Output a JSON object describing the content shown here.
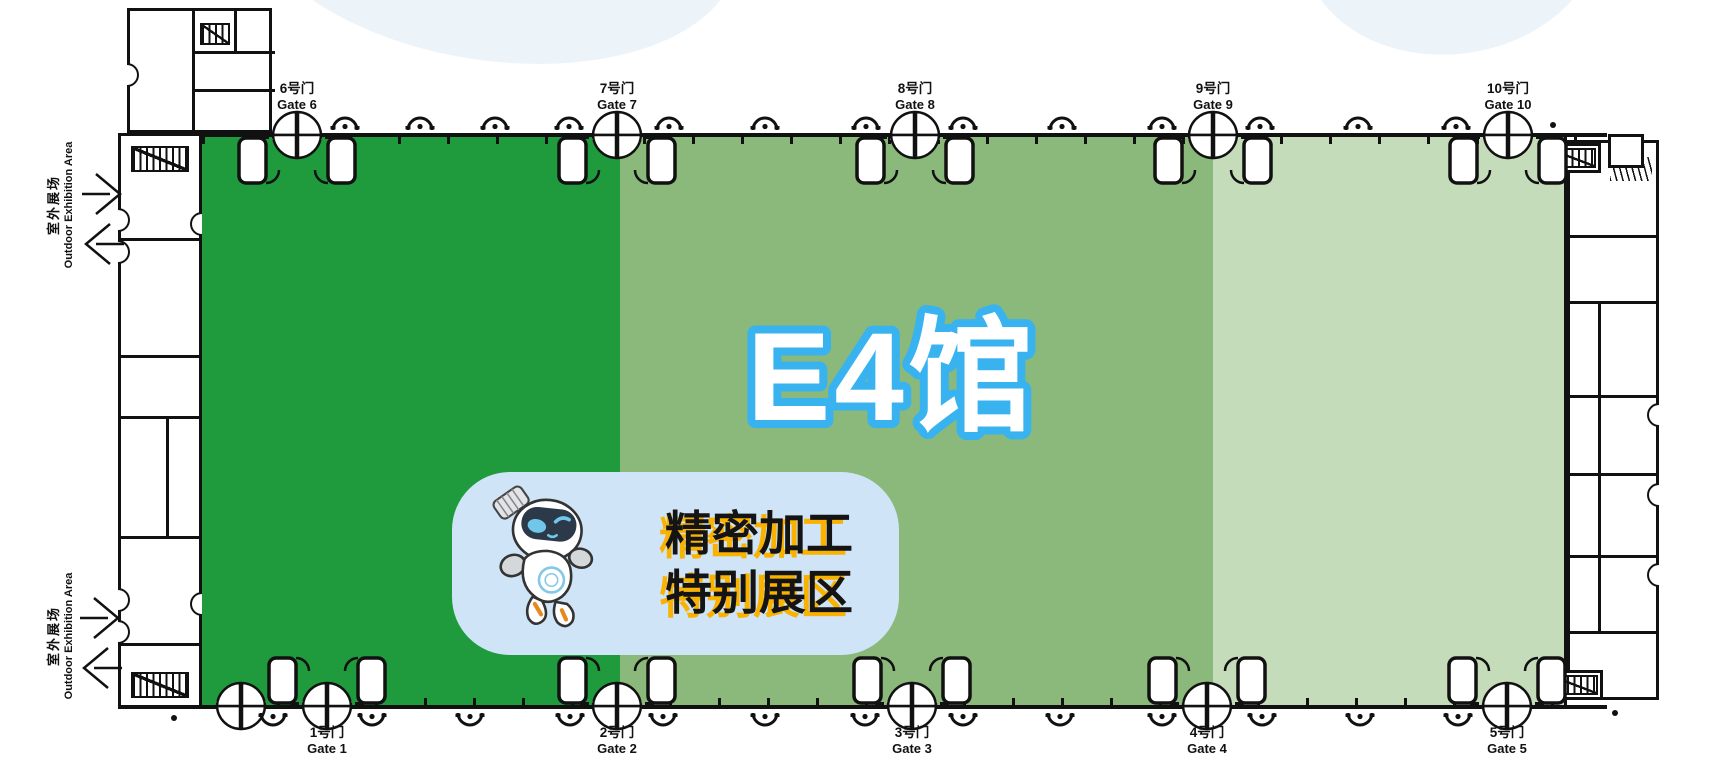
{
  "page": {
    "width": 1709,
    "height": 783,
    "background": "#ffffff"
  },
  "hall": {
    "title": "E4馆",
    "title_fill": "#ffffff",
    "title_stroke": "#38b3ef",
    "zones": [
      {
        "name": "zone-dark-green",
        "color": "#1f9b3d",
        "x": 200,
        "w": 420
      },
      {
        "name": "zone-mid-green",
        "color": "#8ab97b",
        "x": 620,
        "w": 593
      },
      {
        "name": "zone-light-green",
        "color": "#c5dcba",
        "x": 1213,
        "w": 351
      }
    ]
  },
  "gates": {
    "top": [
      {
        "cn": "6号门",
        "en": "Gate 6",
        "x": 297
      },
      {
        "cn": "7号门",
        "en": "Gate 7",
        "x": 617
      },
      {
        "cn": "8号门",
        "en": "Gate 8",
        "x": 915
      },
      {
        "cn": "9号门",
        "en": "Gate 9",
        "x": 1213
      },
      {
        "cn": "10号门",
        "en": "Gate 10",
        "x": 1508
      }
    ],
    "bottom": [
      {
        "cn": "1号门",
        "en": "Gate 1",
        "x": 327
      },
      {
        "cn": "2号门",
        "en": "Gate 2",
        "x": 617
      },
      {
        "cn": "3号门",
        "en": "Gate 3",
        "x": 912
      },
      {
        "cn": "4号门",
        "en": "Gate 4",
        "x": 1207
      },
      {
        "cn": "5号门",
        "en": "Gate 5",
        "x": 1507
      },
      {
        "cn": "",
        "en": "",
        "x": 241,
        "plain": true
      }
    ]
  },
  "door_arcs": {
    "top": [
      345,
      420,
      495,
      569,
      669,
      765,
      866,
      963,
      1062,
      1162,
      1260,
      1358,
      1456
    ],
    "bottom": [
      273,
      372,
      470,
      570,
      663,
      765,
      865,
      963,
      1060,
      1162,
      1262,
      1360,
      1458
    ]
  },
  "outdoor_labels": [
    {
      "cn": "室外展场",
      "en": "Outdoor Exhibition Area"
    },
    {
      "cn": "室外展场",
      "en": "Outdoor Exhibition Area"
    }
  ],
  "callout": {
    "line1": "精密加工",
    "line2": "特别展区",
    "bg": "#cfe4f6",
    "text_color": "#141414",
    "shadow_color": "#f9b200",
    "mascot": "robot-mascot"
  },
  "colors": {
    "wall": "#111111",
    "decor_blob": "#ecf4fa"
  }
}
